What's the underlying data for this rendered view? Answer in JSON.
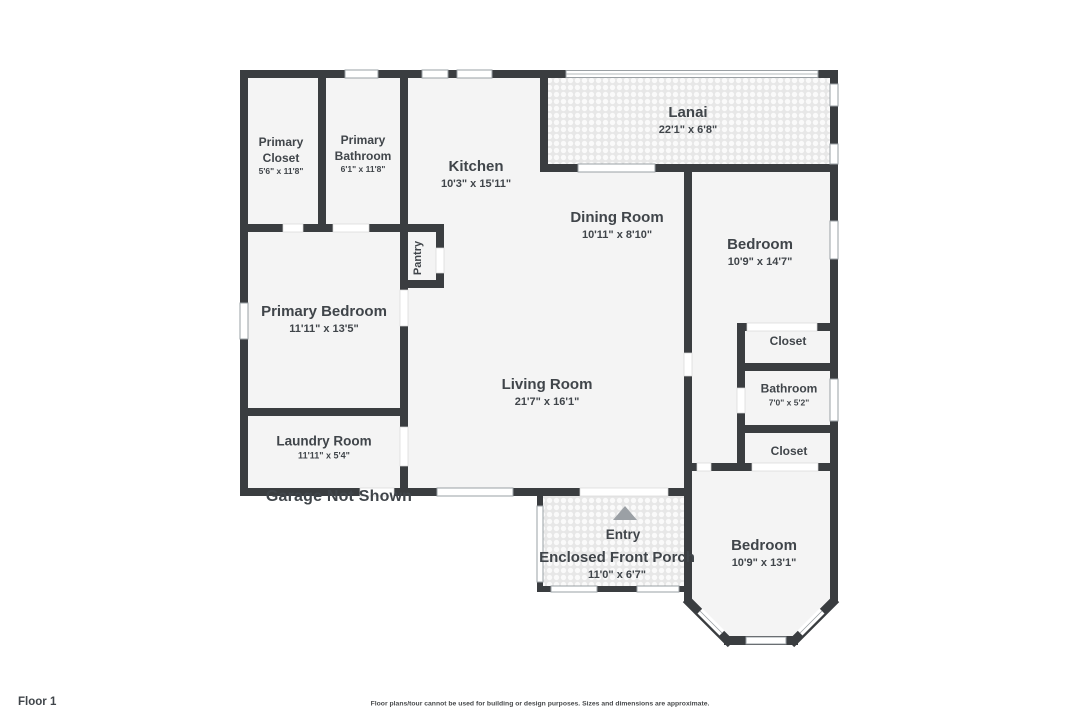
{
  "colors": {
    "wall": "#3a3d40",
    "floor": "#f4f4f4",
    "text": "#40454a",
    "window_stroke": "#9aa0a4",
    "patio_base": "#e7e7e7",
    "patio_dot": "#fafafa",
    "entry_arrow": "#9ba0a5",
    "disclaimer_text": "#47494b"
  },
  "rooms": {
    "lanai": {
      "name": "Lanai",
      "dims": "22'1\" x 6'8\""
    },
    "kitchen": {
      "name": "Kitchen",
      "dims": "10'3\" x 15'11\""
    },
    "dining_room": {
      "name": "Dining Room",
      "dims": "10'11\" x 8'10\""
    },
    "living_room": {
      "name": "Living Room",
      "dims": "21'7\" x 16'1\""
    },
    "primary_closet": {
      "name": "Primary Closet",
      "dims": "5'6\" x 11'8\""
    },
    "primary_bathroom": {
      "name": "Primary Bathroom",
      "dims": "6'1\" x 11'8\""
    },
    "primary_bedroom": {
      "name": "Primary Bedroom",
      "dims": "11'11\" x 13'5\""
    },
    "pantry": {
      "name": "Pantry"
    },
    "laundry_room": {
      "name": "Laundry Room",
      "dims": "11'11\" x 5'4\""
    },
    "bedroom_top": {
      "name": "Bedroom",
      "dims": "10'9\" x 14'7\""
    },
    "closet_top": {
      "name": "Closet"
    },
    "bathroom": {
      "name": "Bathroom",
      "dims": "7'0\" x 5'2\""
    },
    "closet_bottom": {
      "name": "Closet"
    },
    "bedroom_bottom": {
      "name": "Bedroom",
      "dims": "10'9\" x 13'1\""
    },
    "entry": {
      "name": "Entry"
    },
    "porch": {
      "name": "Enclosed Front Porch",
      "dims": "11'0\" x 6'7\""
    }
  },
  "annotations": {
    "garage_note": "Garage Not Shown",
    "floor_label": "Floor 1",
    "disclaimer": "Floor plans/tour cannot be used for building or design purposes. Sizes and dimensions are approximate."
  }
}
